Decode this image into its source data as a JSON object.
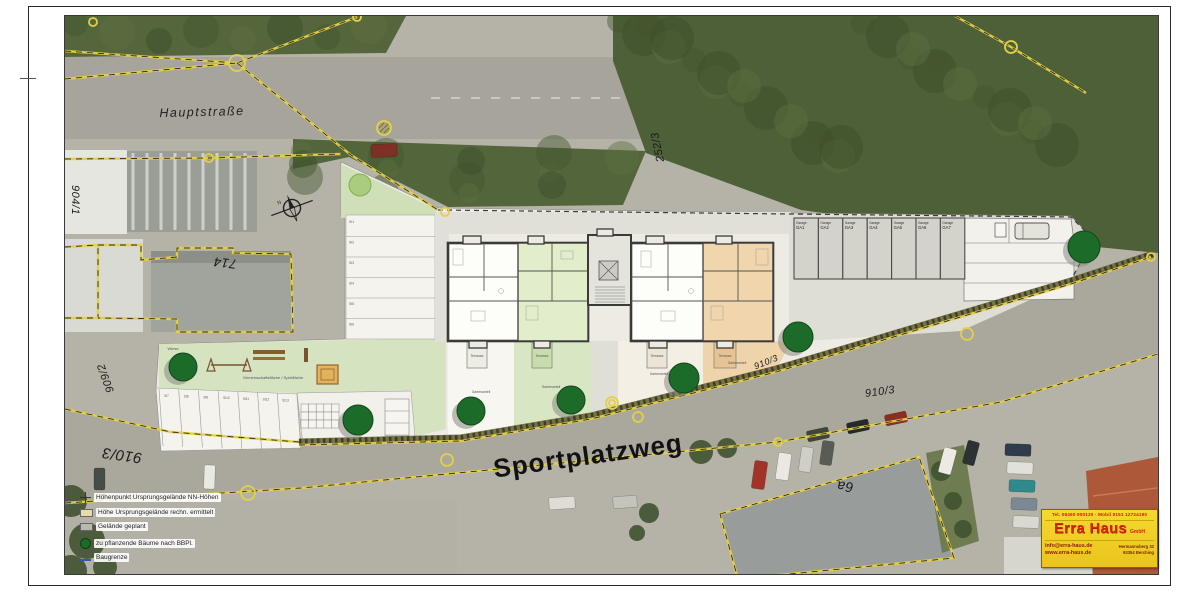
{
  "streets": {
    "hauptstrasse": "Hauptstraße",
    "sportplatzweg": "Sportplatzweg"
  },
  "parcel_labels": [
    {
      "id": "p904",
      "text": "904/1",
      "x": 75,
      "y": 200,
      "rot": 90,
      "size": 11
    },
    {
      "id": "p714",
      "text": "714",
      "x": 225,
      "y": 263,
      "rot": 187,
      "size": 13
    },
    {
      "id": "p252",
      "text": "252/3",
      "x": 658,
      "y": 147,
      "rot": -102,
      "size": 11
    },
    {
      "id": "p909",
      "text": "909/2",
      "x": 106,
      "y": 378,
      "rot": 250,
      "size": 11
    },
    {
      "id": "p910a",
      "text": "910/3",
      "x": 122,
      "y": 455,
      "rot": 188,
      "size": 15
    },
    {
      "id": "p910b",
      "text": "910/3",
      "x": 880,
      "y": 392,
      "rot": -8,
      "size": 11
    },
    {
      "id": "p910c",
      "text": "910/3",
      "x": 766,
      "y": 362,
      "rot": -22,
      "size": 9
    },
    {
      "id": "p6a",
      "text": "6a",
      "x": 845,
      "y": 487,
      "rot": 185,
      "size": 14
    }
  ],
  "legend": [
    {
      "icon": "point-marker",
      "label": "Höhenpunkt Ursprungsgelände NN-Höhen"
    },
    {
      "icon": "box-marker",
      "label": "Höhe Ursprungsgelände rechn. ermittelt"
    },
    {
      "icon": "ground-marker",
      "label": "Gelände geplant"
    },
    {
      "icon": "tree-marker",
      "label": "zu pflanzende Bäume nach BBPl."
    },
    {
      "icon": "line-marker",
      "label": "Baugrenze"
    }
  ],
  "company": {
    "phone_line": "Tel. 08460 900130  ·  Mobil 0151 12724190",
    "name": "Erra Haus",
    "suffix": "GmbH",
    "email": "info@erra-haus.de",
    "website": "www.erra-haus.de",
    "address_line1": "Hermannsberg 32",
    "address_line2": "93354 Berching"
  },
  "site_plan": {
    "garage_label": "Garage",
    "garages": [
      "GA1",
      "GA2",
      "GA3",
      "GA4",
      "GA5",
      "GA6",
      "GA7"
    ],
    "stalls_top": [
      "St1",
      "St2",
      "St3",
      "St4",
      "St5",
      "St6"
    ],
    "stalls_bottom": [
      "St7",
      "St8",
      "St9",
      "St10",
      "St11",
      "St12",
      "St13"
    ],
    "terrace_label": "Terrasse",
    "garden_label": "Gartenanteil",
    "playground_label": "Gemeinschaftsfläche / Spielfläche",
    "meadow_label": "Wiese"
  },
  "trees": {
    "planted": [
      [
        182,
        366,
        14
      ],
      [
        357,
        419,
        15
      ],
      [
        470,
        410,
        14
      ],
      [
        570,
        399,
        14
      ],
      [
        683,
        377,
        15
      ],
      [
        797,
        336,
        15
      ],
      [
        1083,
        246,
        16
      ]
    ],
    "existing_light": [
      [
        359,
        184,
        11
      ]
    ]
  },
  "survey_points": [
    {
      "x": 236,
      "y": 62,
      "r": 8
    },
    {
      "x": 383,
      "y": 127,
      "r": 7,
      "hatched": true
    },
    {
      "x": 1010,
      "y": 46,
      "r": 6
    },
    {
      "x": 444,
      "y": 211,
      "r": 4
    },
    {
      "x": 208,
      "y": 157,
      "r": 4
    },
    {
      "x": 356,
      "y": 16,
      "r": 4
    },
    {
      "x": 92,
      "y": 21,
      "r": 4
    },
    {
      "x": 247,
      "y": 492,
      "r": 7
    },
    {
      "x": 446,
      "y": 459,
      "r": 6
    },
    {
      "x": 611,
      "y": 402,
      "r": 6
    },
    {
      "x": 611,
      "y": 402,
      "r": 3
    },
    {
      "x": 637,
      "y": 416,
      "r": 5
    },
    {
      "x": 966,
      "y": 333,
      "r": 6
    },
    {
      "x": 1150,
      "y": 256,
      "r": 4
    },
    {
      "x": 777,
      "y": 441,
      "r": 4
    }
  ],
  "boundaries": {
    "yellow": [
      [
        [
          64,
          50
        ],
        [
          236,
          62
        ]
      ],
      [
        [
          64,
          78
        ],
        [
          236,
          62
        ]
      ],
      [
        [
          236,
          62
        ],
        [
          356,
          16
        ]
      ],
      [
        [
          236,
          62
        ],
        [
          350,
          154
        ],
        [
          437,
          209
        ]
      ],
      [
        [
          64,
          158
        ],
        [
          208,
          157
        ],
        [
          340,
          153
        ]
      ],
      [
        [
          97,
          244
        ],
        [
          140,
          244
        ],
        [
          140,
          259
        ],
        [
          176,
          256
        ],
        [
          176,
          247
        ],
        [
          232,
          247
        ],
        [
          232,
          252
        ],
        [
          290,
          253
        ],
        [
          292,
          331
        ],
        [
          176,
          331
        ],
        [
          176,
          318
        ],
        [
          97,
          317
        ],
        [
          97,
          244
        ]
      ],
      [
        [
          64,
          246
        ],
        [
          97,
          244
        ]
      ],
      [
        [
          64,
          317
        ],
        [
          97,
          317
        ]
      ],
      [
        [
          64,
          408
        ],
        [
          170,
          431
        ],
        [
          298,
          441
        ]
      ],
      [
        [
          298,
          444
        ],
        [
          460,
          440
        ],
        [
          590,
          418
        ],
        [
          775,
          371
        ],
        [
          1070,
          283
        ],
        [
          1150,
          256
        ]
      ],
      [
        [
          64,
          502
        ],
        [
          300,
          487
        ],
        [
          540,
          464
        ],
        [
          777,
          441
        ],
        [
          1000,
          401
        ],
        [
          1157,
          353
        ]
      ],
      [
        [
          719,
          513
        ],
        [
          918,
          456
        ],
        [
          953,
          557
        ],
        [
          737,
          578
        ],
        [
          719,
          513
        ]
      ],
      [
        [
          954,
          15
        ],
        [
          1010,
          46
        ],
        [
          1085,
          92
        ]
      ]
    ],
    "black_dash": [
      [
        [
          437,
          209
        ],
        [
          788,
          213
        ],
        [
          1070,
          216
        ],
        [
          1092,
          238
        ]
      ],
      [
        [
          1092,
          238
        ],
        [
          1069,
          281
        ]
      ]
    ]
  },
  "cars": [
    [
      370,
      143,
      26,
      13,
      "#7e3026",
      -2
    ],
    [
      203,
      464,
      11,
      24,
      "#e9e9e3",
      2
    ],
    [
      93,
      467,
      11,
      22,
      "#454d46",
      0
    ],
    [
      548,
      496,
      26,
      12,
      "#dedcd4",
      -4
    ],
    [
      612,
      495,
      24,
      12,
      "#c4c4bd",
      -4
    ],
    [
      752,
      460,
      13,
      28,
      "#a23327",
      8
    ],
    [
      776,
      452,
      13,
      27,
      "#ebe8e1",
      8
    ],
    [
      799,
      446,
      12,
      25,
      "#cfcfc8",
      8
    ],
    [
      820,
      440,
      12,
      24,
      "#575c55",
      8
    ],
    [
      806,
      428,
      22,
      11,
      "#3e443e",
      -12
    ],
    [
      846,
      420,
      22,
      11,
      "#24292b",
      -12
    ],
    [
      884,
      412,
      22,
      11,
      "#8d2e21",
      -12
    ],
    [
      940,
      447,
      13,
      26,
      "#eceae3",
      15
    ],
    [
      964,
      440,
      12,
      24,
      "#2c3134",
      15
    ],
    [
      1004,
      443,
      26,
      12,
      "#2f3c4b",
      2
    ],
    [
      1006,
      461,
      26,
      12,
      "#e0e1da",
      2
    ],
    [
      1008,
      479,
      26,
      12,
      "#2f8b8b",
      2
    ],
    [
      1010,
      497,
      26,
      12,
      "#7b8995",
      2
    ],
    [
      1012,
      515,
      26,
      12,
      "#d9d9d2",
      2
    ]
  ],
  "bushes": [
    [
      700,
      451,
      12
    ],
    [
      726,
      447,
      10
    ],
    [
      70,
      500,
      16
    ],
    [
      86,
      540,
      18
    ],
    [
      70,
      570,
      16
    ],
    [
      104,
      566,
      12
    ],
    [
      940,
      470,
      10
    ],
    [
      952,
      500,
      9
    ],
    [
      962,
      528,
      9
    ],
    [
      648,
      512,
      10
    ],
    [
      636,
      532,
      8
    ]
  ],
  "colors": {
    "boundary_yellow": "#e3cf48",
    "tree_green": "#1d6b28",
    "tree_light": "#a9cc7e",
    "plan_green": "#d8e6c3",
    "plan_orange": "#eed3ab",
    "company_yellow": "#f2cf2a",
    "company_red": "#d62300"
  }
}
